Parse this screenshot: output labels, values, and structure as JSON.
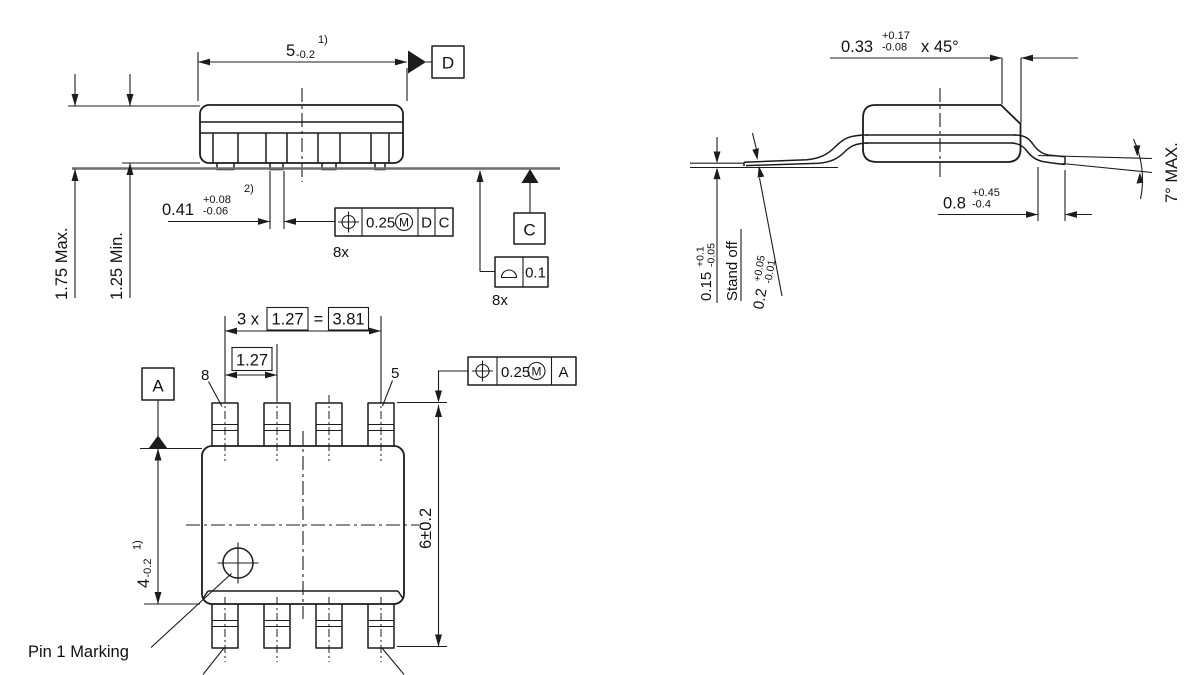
{
  "front": {
    "length_v": "5",
    "length_t": "-0.2",
    "length_n": "1)",
    "datum_d": "D",
    "h_max": "1.75 Max.",
    "h_min": "1.25 Min.",
    "leadw_v": "0.41",
    "leadw_tp": "+0.08",
    "leadw_tm": "-0.06",
    "leadw_n": "2)",
    "fcf1_tol": "0.25",
    "fcf1_mod": "M",
    "fcf1_d1": "D",
    "fcf1_d2": "C",
    "fcf1_count": "8x",
    "datum_c": "C",
    "fcf2_tol": "0.1",
    "fcf2_count": "8x"
  },
  "side": {
    "chamfer_v": "0.33",
    "chamfer_tp": "+0.17",
    "chamfer_tm": "-0.08",
    "chamfer_suffix": "x 45°",
    "foot_v": "0.8",
    "foot_tp": "+0.45",
    "foot_tm": "-0.4",
    "thick_v": "0.2",
    "thick_tp": "+0.05",
    "thick_tm": "-0.01",
    "standoff_v": "0.15",
    "standoff_tp": "+0.1",
    "standoff_tm": "-0.05",
    "standoff_label": "Stand off",
    "angle": "7° MAX."
  },
  "bottom": {
    "pitch3_prefix": "3 x",
    "pitch3_pitch": "1.27",
    "pitch3_eq": "=",
    "pitch3_total": "3.81",
    "pitch1": "1.27",
    "pin_top_left": "8",
    "pin_top_right": "5",
    "datum_a": "A",
    "width_v": "4",
    "width_t": "-0.2",
    "width_n": "1)",
    "span": "6±0.2",
    "fcf_tol": "0.25",
    "fcf_mod": "M",
    "fcf_d1": "A",
    "pin1_label": "Pin 1 Marking"
  },
  "colors": {
    "line": "#1c1c1c",
    "seating_plane": "#6f6f6f",
    "background": "#ffffff"
  }
}
